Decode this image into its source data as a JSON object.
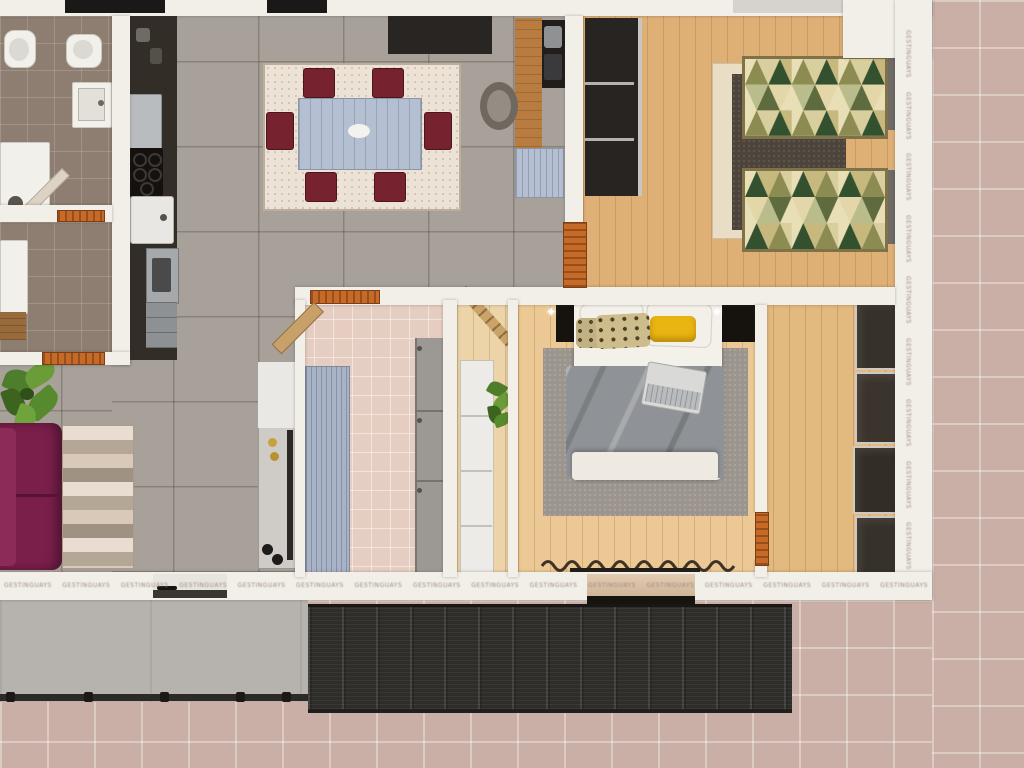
{
  "scene": {
    "type": "top-down 3D floor plan render",
    "subject": "apartment with two bedrooms, walk-in closet, two bathrooms, open living-dining-kitchen and wrap-around tiled terrace"
  },
  "watermark": {
    "text": "GESTINGUAYS",
    "color": "#9c8b80"
  },
  "palette": {
    "wall": "#f2efe8",
    "winDark": "#1b1917",
    "grayTile": "#a7a19a",
    "bathTile": "#8d7e71",
    "pinkTile": "#e6cdc1",
    "woodKids": "#deb076",
    "woodMaster": "#ecc994",
    "woodCorridor": "#ecd4a8",
    "woodCloset": "#e2b97f",
    "terrace": "#c9afa5",
    "concrete": "#b6b2ae",
    "pergola": "#2f2d2a",
    "door": "#c76a28",
    "sofa": "#7a1f4a",
    "duvet": "#8f9296",
    "rugMaster": "#9b958d",
    "rugKids": "#4d443c",
    "table": "#b4bfd1",
    "chair": "#77222f",
    "counter": "#332d28",
    "yellow": "#e9b511",
    "headboard": "#16130f"
  },
  "rooms": {
    "bathroom": {
      "name": "bathroom",
      "items": [
        "toilet",
        "bidet",
        "washbasin",
        "shower",
        "open door"
      ]
    },
    "laundry": {
      "name": "laundry room",
      "items": [
        "washing machine",
        "wood shelf",
        "open door"
      ]
    },
    "kitchen": {
      "name": "kitchen",
      "items": [
        "tall cabinet",
        "fridge",
        "cooktop with burners",
        "sink",
        "oven",
        "drawer unit"
      ]
    },
    "living_dining": {
      "name": "living and dining area",
      "items": [
        "wall sideboard",
        "dining rug",
        "dining table",
        "six maroon chairs",
        "wooden desk",
        "desk chair",
        "desk appliances",
        "blue cabinet",
        "shelving unit",
        "potted plant",
        "purple sofa",
        "striped rug",
        "sliding door"
      ]
    },
    "kids_bedroom": {
      "name": "second bedroom",
      "items": [
        "open wardrobe",
        "two single beds with geometric covers",
        "dark rug",
        "runner rug",
        "open door"
      ]
    },
    "hall_bathroom2": {
      "name": "second bathroom / utility room",
      "items": [
        "blue slat wardrobe",
        "gray storage panels",
        "open door"
      ]
    },
    "corridor": {
      "name": "corridor",
      "items": [
        "leaning ladder",
        "white cabinet column",
        "potted plant"
      ]
    },
    "master_bedroom": {
      "name": "master bedroom",
      "items": [
        "double bed",
        "black headboard panel",
        "two reading lamps",
        "leopard pillows",
        "yellow pillow",
        "laptop on bed",
        "area rug",
        "curtain",
        "glass door to terrace"
      ]
    },
    "walk_in_closet": {
      "name": "walk-in closet",
      "items": [
        "four dark wardrobe modules",
        "open door"
      ]
    },
    "terrace": {
      "name": "terrace",
      "items": [
        "pink tiled deck",
        "concrete patio",
        "railing posts",
        "dark slatted pergola"
      ]
    }
  }
}
